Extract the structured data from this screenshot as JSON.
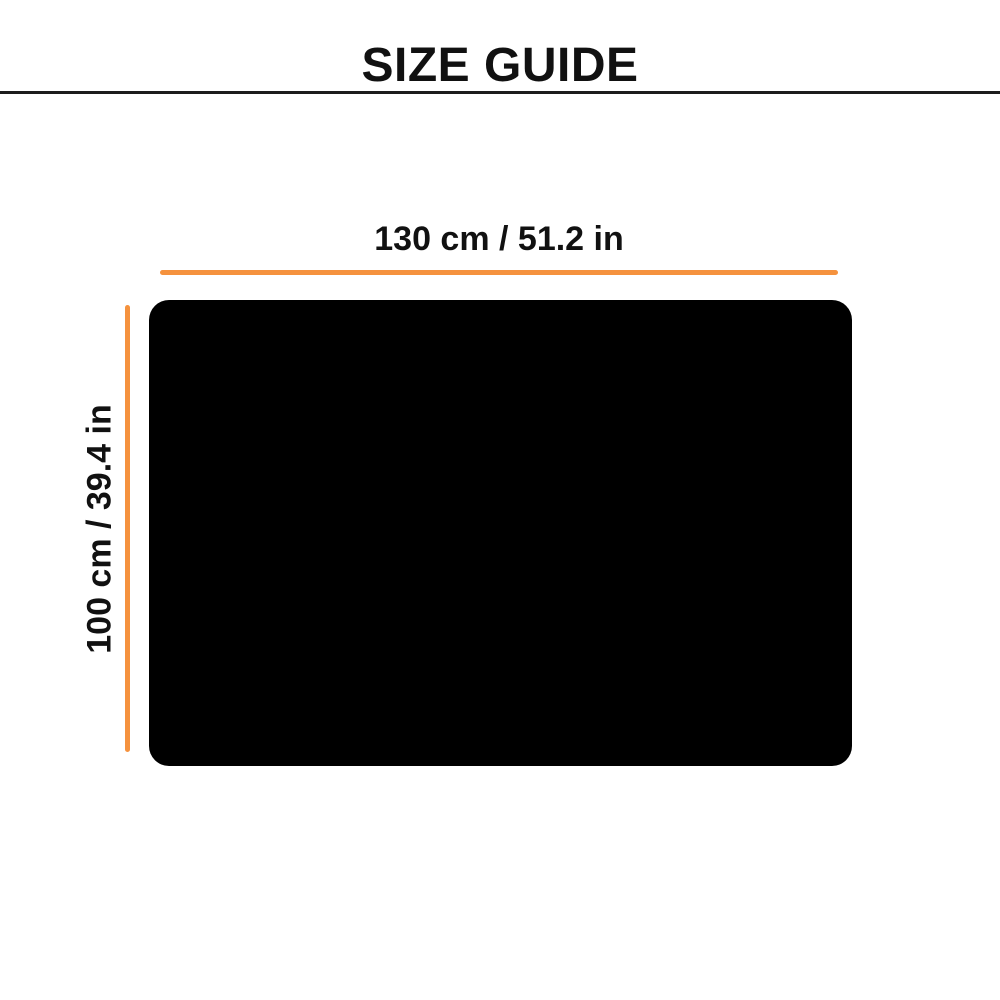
{
  "header": {
    "title": "SIZE GUIDE"
  },
  "size_diagram": {
    "product_shape": "black rounded rectangle (top view of product)",
    "dimensions": {
      "width": {
        "cm": 130,
        "in": 51.2,
        "label": "130 cm / 51.2 in"
      },
      "height": {
        "cm": 100,
        "in": 39.4,
        "label": "100 cm / 39.4 in"
      }
    }
  },
  "colors": {
    "accent": "#f5923e",
    "product": "#000000",
    "divider": "#1c1c1c",
    "text": "#111111",
    "background": "#ffffff"
  }
}
